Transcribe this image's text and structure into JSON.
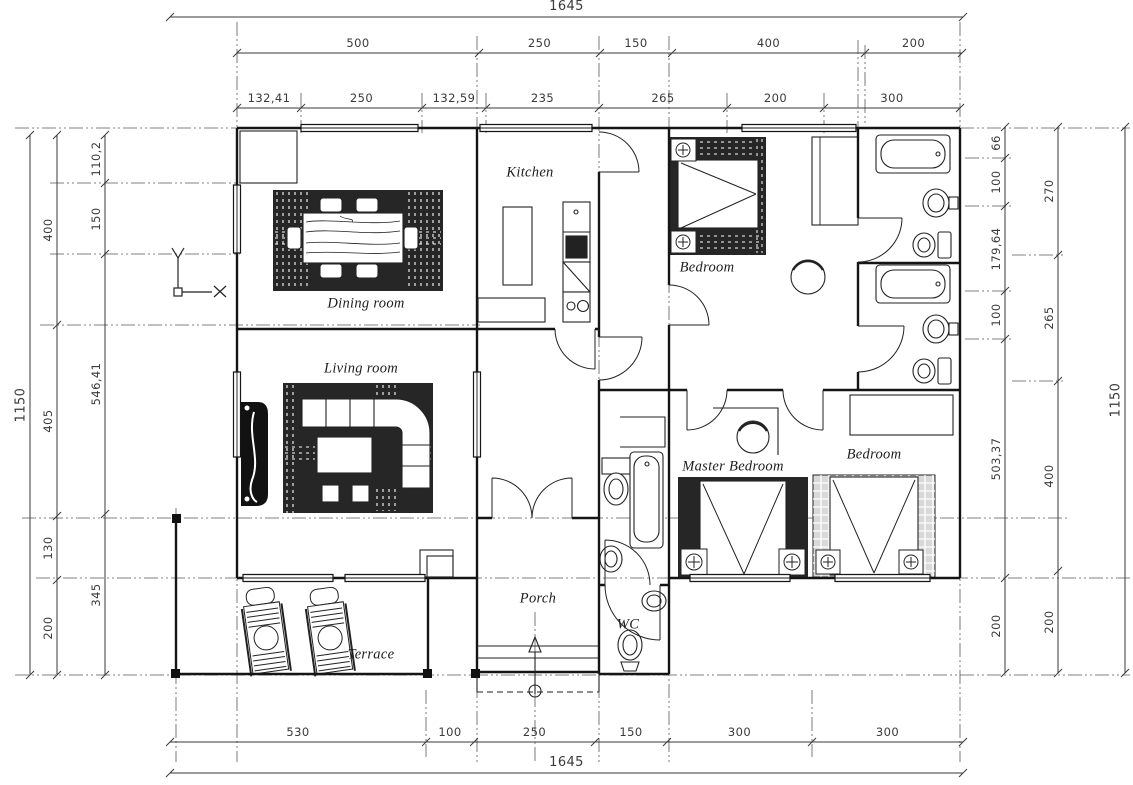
{
  "drawing": {
    "type": "house floor plan",
    "colors": {
      "line": "#151515",
      "rug_dark": "#262626",
      "rug_grid": "#d9d9d9",
      "dim_text": "#3a3a3a",
      "background": "#ffffff"
    }
  },
  "rooms": {
    "kitchen": "Kitchen",
    "dining": "Dining room",
    "living": "Living room",
    "bedroom_top": "Bedroom",
    "bedroom_right": "Bedroom",
    "master": "Master Bedroom",
    "porch": "Porch",
    "wc": "WC",
    "terrace": "Terrace"
  },
  "dimensions": {
    "top_overall": "1645",
    "top_row2": [
      "500",
      "250",
      "150",
      "400",
      "200"
    ],
    "top_row3": [
      "132,41",
      "250",
      "132,59",
      "235",
      "265",
      "200",
      "300"
    ],
    "bottom_row": [
      "530",
      "100",
      "250",
      "150",
      "300",
      "300"
    ],
    "bottom_overall": "1645",
    "left_outer": "1150",
    "left_mid": [
      "400",
      "405",
      "130",
      "200"
    ],
    "left_inner": [
      "110,2",
      "150",
      "546,41",
      "345"
    ],
    "right_inner": [
      "66",
      "100",
      "179,64",
      "100",
      "503,37",
      "200"
    ],
    "right_mid": [
      "270",
      "265",
      "400",
      "200"
    ],
    "right_outer": "1150"
  }
}
